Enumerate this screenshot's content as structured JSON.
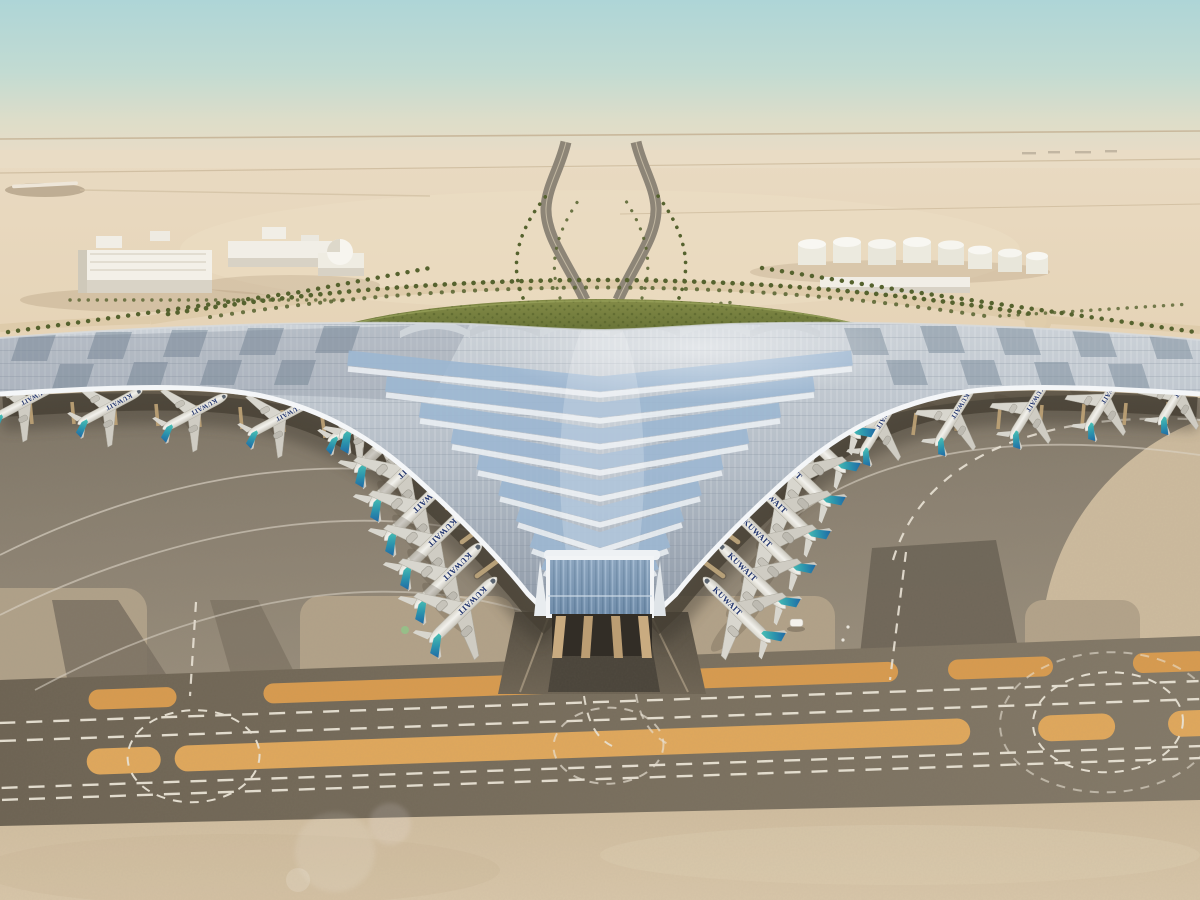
{
  "meta": {
    "title": "Aerial architectural rendering of a trefoil-roofed airport terminal in a desert, with KUWAIT-livery aircraft parked at the gates",
    "domain": "Natural-Image"
  },
  "scene": {
    "sky": {
      "top_color": "#aed5d7",
      "mid_color": "#cfdcd0",
      "horizon_color": "#e9dcc6"
    },
    "desert": {
      "far_color": "#e8d8bf",
      "mid_color": "#e0cbaa",
      "foreground_color": "#d5c2a4"
    },
    "background": {
      "left_district": "white low-rise warehouses with a small dome building",
      "right_district": "white cylindrical fuel-storage tanks",
      "roads": "palm-lined approach roads forming a Y behind the terminal",
      "green_area": "crescent-shaped landscaped garden wrapping the landside of the roof"
    },
    "terminal": {
      "roof_silver": "#b7c0c9",
      "roof_glass_blue": "#9db7d2",
      "roof_rib_white": "#f2f4f6",
      "facade_glass": "#7e98b4",
      "column_tan": "#c9ab80"
    },
    "aircraft": {
      "livery_text": "KUWAIT",
      "livery_text_color": "#22356e",
      "fuselage_color": "#efeee8",
      "tail_teal": "#49c0b4",
      "tail_blue": "#1f63a4",
      "count_left_pier": 7,
      "count_right_pier": 7,
      "count_left_wing": 5,
      "count_right_wing": 5
    },
    "apron": {
      "concrete_color": "#8c8272",
      "taxiway_band_color": "#756b5b",
      "marking_dash_color": "#ece6d8",
      "shoulder_stripe_color": "#d89b4f"
    },
    "vehicles": {
      "service_vehicle_color": "#f4f2ec",
      "count": 1
    }
  }
}
